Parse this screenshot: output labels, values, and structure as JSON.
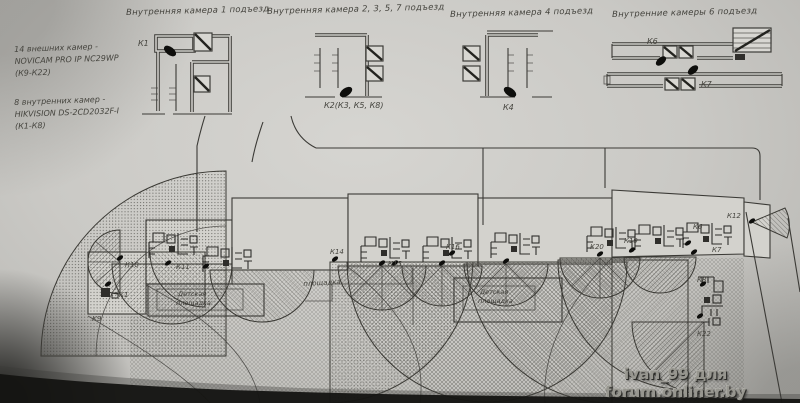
{
  "header_titles": {
    "entrance1": "Внутренняя камера 1 подъезд",
    "entrance2357": "Внутренняя камера 2, 3, 5, 7 подъезд",
    "entrance4": "Внутренняя камера 4 подъезд",
    "entrance6": "Внутренние камеры 6 подъезд"
  },
  "camera_specs": {
    "external_line1": "14 внешних камер -",
    "external_line2": "NOVICAM PRO IP NC29WP",
    "external_line3": "(К9-К22)",
    "internal_line1": "8 внутренних камер -",
    "internal_line2": "HIKVISION DS-2CD2032F-I",
    "internal_line3": "(К1-К8)"
  },
  "detail_plans": {
    "plan1_camera": "К1",
    "plan2_camera": "К2(К3, К5, К8)",
    "plan3_camera": "К4",
    "plan4_camera_top": "К6",
    "plan4_camera_bottom": "К7"
  },
  "site_plan": {
    "k9": "К9",
    "k1": "К1",
    "k10": "К10",
    "k11": "К11",
    "k14": "К14",
    "k15": "К15",
    "k16": "К16",
    "k19": "К19",
    "k20": "К20",
    "k6": "К6",
    "k7": "К7",
    "k12": "К12",
    "k8": "К8",
    "k22": "К22",
    "area_note": "площадка",
    "playground_line1": "Детская",
    "playground_line2": "площадка"
  },
  "watermark": "ivan_99 для forum.onliner.by",
  "colors": {
    "paper": "#cac9c5",
    "ink": "#3b3a36",
    "camera_dot": "#0e0e0c",
    "watermark_gray": "#97968f"
  }
}
